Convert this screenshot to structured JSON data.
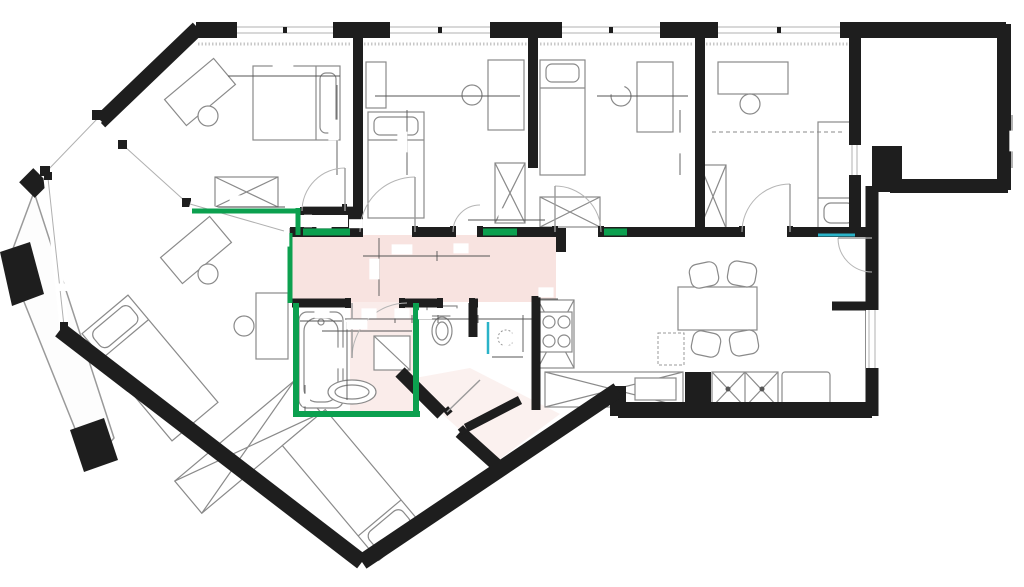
{
  "title": "Apartment floor plan with measurements",
  "colors": {
    "wall": "#1e1e1e",
    "green_wall": "#0ca04f",
    "highlight_pink": "#f3d0cb",
    "annotation_red": "#d5404e",
    "accent_cyan": "#2ab3c8",
    "furniture": "#8a8a8a"
  },
  "room_labels": [
    {
      "text": "BALKON",
      "x": 70,
      "y": 289,
      "rot": 0,
      "size": 6.5
    },
    {
      "text": "pralka",
      "x": 806,
      "y": 398,
      "rot": 0,
      "size": 7
    }
  ],
  "dims": [
    {
      "text": "303",
      "x": 283,
      "y": 72,
      "rot": 0,
      "size": 9
    },
    {
      "text": "296",
      "x": 336,
      "y": 130,
      "rot": -90,
      "size": 9
    },
    {
      "text": "300",
      "x": 447,
      "y": 92,
      "rot": 0,
      "size": 9
    },
    {
      "text": "337",
      "x": 405,
      "y": 142,
      "rot": -90,
      "size": 9
    },
    {
      "text": "280",
      "x": 614,
      "y": 92,
      "rot": 0,
      "size": 9
    },
    {
      "text": "337",
      "x": 679,
      "y": 143,
      "rot": -90,
      "size": 9
    },
    {
      "text": "337",
      "x": 777,
      "y": 128,
      "rot": 0,
      "size": 9
    },
    {
      "text": "337",
      "x": 1017,
      "y": 141,
      "rot": -90,
      "size": 9
    },
    {
      "text": "205",
      "x": 240,
      "y": 203,
      "rot": 0,
      "size": 9
    },
    {
      "text": "118",
      "x": 330,
      "y": 203,
      "rot": 0,
      "size": 9
    },
    {
      "text": "40",
      "x": 310,
      "y": 221,
      "rot": -90,
      "size": 7
    },
    {
      "text": "90",
      "x": 324,
      "y": 226,
      "rot": 0,
      "size": 9
    },
    {
      "text": "19",
      "x": 356,
      "y": 226,
      "rot": 0,
      "size": 8
    },
    {
      "text": "54",
      "x": 287,
      "y": 239,
      "rot": -90,
      "size": 9
    },
    {
      "text": "91",
      "x": 285,
      "y": 271,
      "rot": -90,
      "size": 9
    },
    {
      "text": "130",
      "x": 402,
      "y": 252,
      "rot": 0,
      "size": 9
    },
    {
      "text": "93",
      "x": 461,
      "y": 251,
      "rot": 0,
      "size": 9
    },
    {
      "text": "123",
      "x": 377,
      "y": 269,
      "rot": -90,
      "size": 9
    },
    {
      "text": "78",
      "x": 506,
      "y": 216,
      "rot": 0,
      "size": 9
    },
    {
      "text": "88",
      "x": 322,
      "y": 316,
      "rot": 0,
      "size": 9
    },
    {
      "text": "214",
      "x": 357,
      "y": 327,
      "rot": 0,
      "size": 9
    },
    {
      "text": "91",
      "x": 369,
      "y": 316,
      "rot": 0,
      "size": 9
    },
    {
      "text": "35",
      "x": 402,
      "y": 316,
      "rot": 0,
      "size": 9
    },
    {
      "text": "32",
      "x": 425,
      "y": 317,
      "rot": 0,
      "size": 8
    },
    {
      "text": "91",
      "x": 458,
      "y": 316,
      "rot": 0,
      "size": 9
    },
    {
      "text": "81",
      "x": 505,
      "y": 316,
      "rot": 0,
      "size": 9
    },
    {
      "text": "33",
      "x": 546,
      "y": 295,
      "rot": 0,
      "size": 9
    },
    {
      "text": "110",
      "x": 520,
      "y": 333,
      "rot": -90,
      "size": 9
    },
    {
      "text": "70",
      "x": 508,
      "y": 353,
      "rot": 0,
      "size": 9
    },
    {
      "text": "193",
      "x": 343,
      "y": 358,
      "rot": -90,
      "size": 9
    },
    {
      "text": "25",
      "x": 308,
      "y": 400,
      "rot": -90,
      "size": 7
    }
  ],
  "tape_icons": [
    {
      "x": 250,
      "y": 133,
      "rot": 15
    },
    {
      "x": 366,
      "y": 135,
      "rot": 75
    },
    {
      "x": 618,
      "y": 135,
      "rot": 75
    },
    {
      "x": 776,
      "y": 138,
      "rot": 75
    },
    {
      "x": 938,
      "y": 107,
      "rot": 80
    },
    {
      "x": 436,
      "y": 263,
      "rot": 5
    },
    {
      "x": 215,
      "y": 317,
      "rot": 75
    },
    {
      "x": 679,
      "y": 313,
      "rot": 0
    },
    {
      "x": 805,
      "y": 265,
      "rot": 0
    },
    {
      "x": 431,
      "y": 341,
      "rot": 80
    },
    {
      "x": 352,
      "y": 393,
      "rot": 5
    },
    {
      "x": 340,
      "y": 457,
      "rot": -40
    }
  ]
}
